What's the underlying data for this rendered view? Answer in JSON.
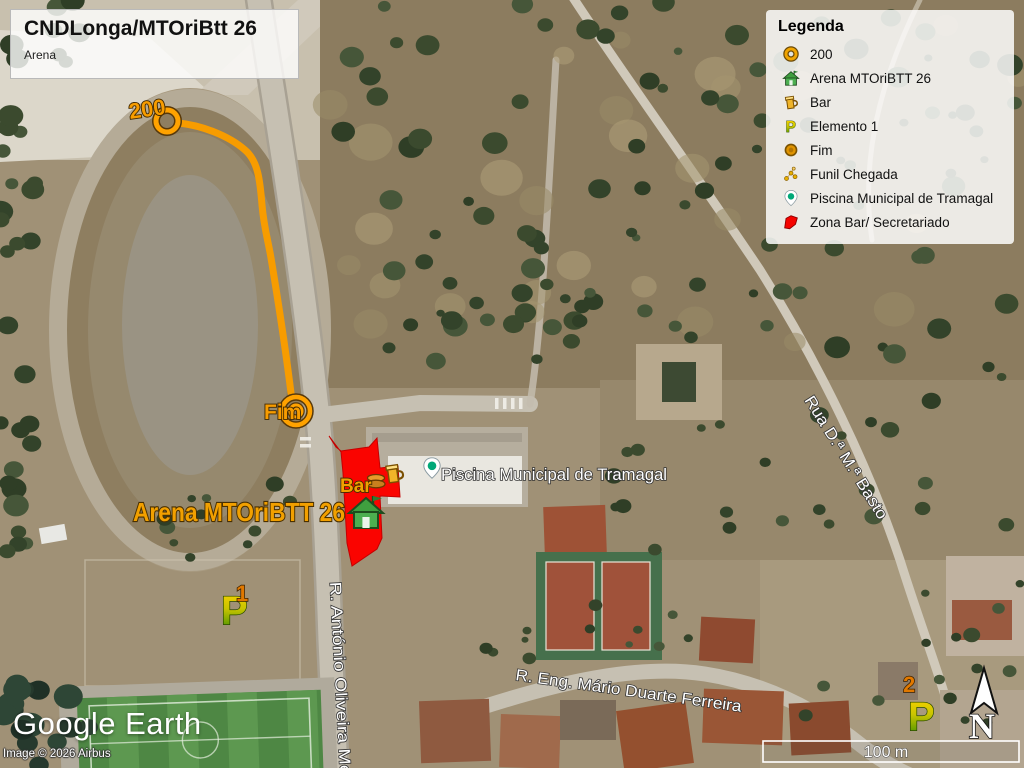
{
  "title_box": {
    "title": "CNDLonga/MTOriBtt 26",
    "subtitle": "Arena"
  },
  "legend": {
    "title": "Legenda",
    "items": [
      {
        "icon": "control-circle-icon",
        "label": "200"
      },
      {
        "icon": "arena-house-icon",
        "label": "Arena MTOriBTT 26"
      },
      {
        "icon": "bar-mug-icon",
        "label": "Bar"
      },
      {
        "icon": "element-flag-icon",
        "label": "Elemento 1"
      },
      {
        "icon": "finish-circle-icon",
        "label": "Fim"
      },
      {
        "icon": "funnel-dots-icon",
        "label": "Funil Chegada"
      },
      {
        "icon": "pool-pin-icon",
        "label": "Piscina Municipal de Tramagal"
      },
      {
        "icon": "red-zone-icon",
        "label": "Zona Bar/ Secretariado"
      }
    ]
  },
  "map": {
    "labels": {
      "control_200": "200",
      "fim": "Fim",
      "bar": "Bar",
      "arena": "Arena MTOriBTT 26",
      "piscina": "Piscina Municipal de Tramagal",
      "marker1": "1",
      "marker2": "2",
      "street_vertical": "R. António Oliveira Men",
      "street_bottom": "R. Eng. Mário Duarte Ferreira",
      "street_diagonal": "Rua D.ª M.ª Basto"
    },
    "colors": {
      "route_orange": "#F79C00",
      "zone_red": "#FA0400",
      "label_orange": "#F2A000",
      "pool_teal": "#00A878"
    }
  },
  "compass": {
    "label": "N"
  },
  "scale_bar": {
    "label": "100 m"
  },
  "footer": {
    "logo": "Google Earth",
    "attribution": "Image © 2026 Airbus"
  }
}
